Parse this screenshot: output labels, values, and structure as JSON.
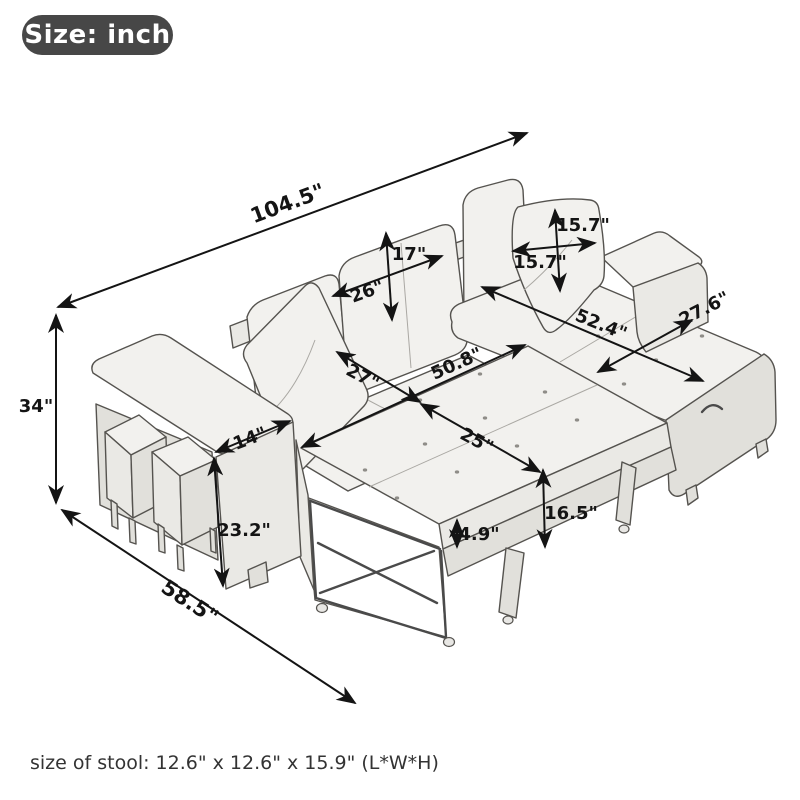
{
  "badge": {
    "label": "Size: inch"
  },
  "dimensions": {
    "overall_length": "104.5\"",
    "overall_height": "34\"",
    "overall_depth": "58.5\"",
    "back_cushion_height": "17\"",
    "back_cushion_width": "26\"",
    "pillow_height": "15.7\"",
    "pillow_width": "15.7\"",
    "chaise_length": "52.4\"",
    "chaise_width": "27.6\"",
    "bed_width": "50.8\"",
    "seat_depth": "27\"",
    "bed_extension_depth": "25\"",
    "bed_height": "16.5\"",
    "mattress_thickness": "4.9\"",
    "arm_width": "14\"",
    "arm_height": "23.2\""
  },
  "footer": {
    "stool_size": "size of stool: 12.6\" x 12.6\" x 15.9\" (L*W*H)"
  },
  "colors": {
    "badge_background": "#474747",
    "badge_text": "#ffffff",
    "dimension_line": "#141414",
    "sketch_line": "#55534f",
    "fabric_fill": "#f2f1ee",
    "background": "#ffffff"
  }
}
